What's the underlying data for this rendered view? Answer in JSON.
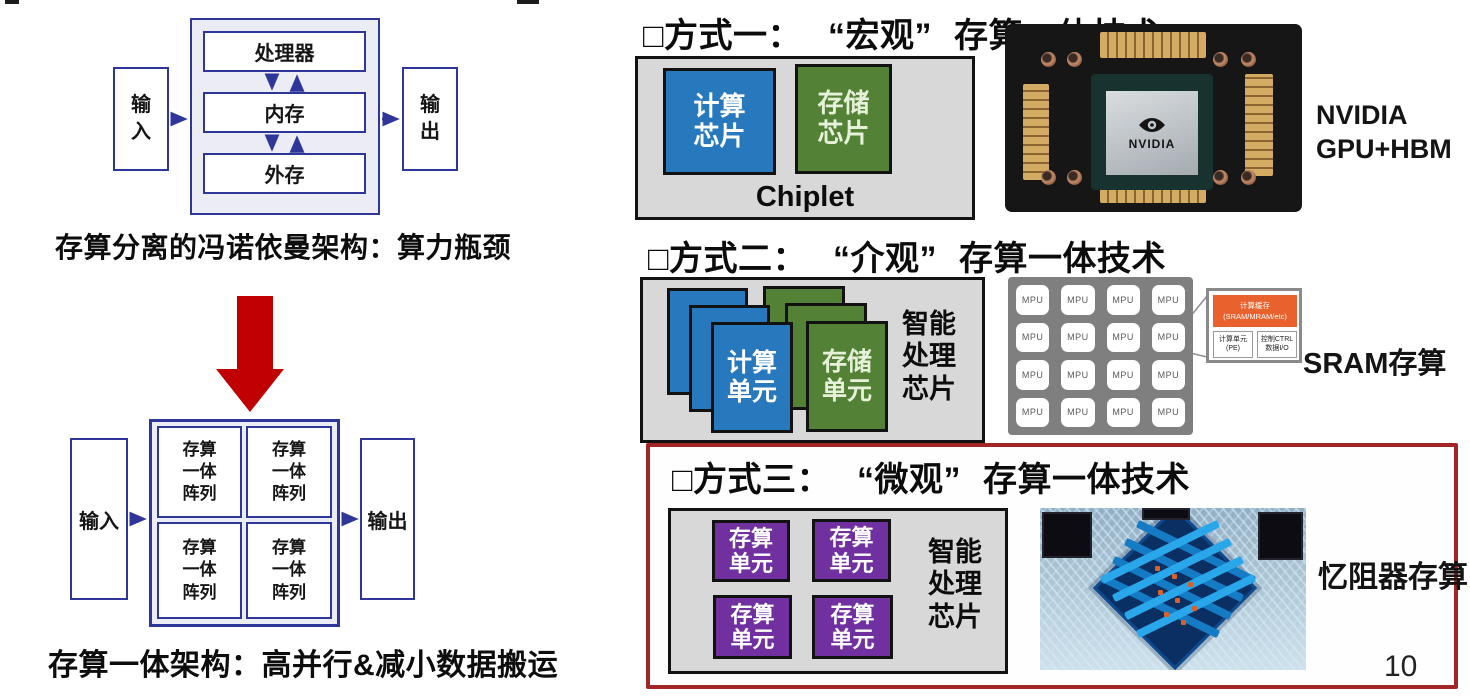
{
  "page": {
    "number": "10"
  },
  "colors": {
    "diagram_navy": "#2f3699",
    "red_arrow": "#c00000",
    "chip_blue": "#2878be",
    "chip_green": "#538135",
    "chip_purple": "#7030a0",
    "section3_border": "#a32626",
    "callout_orange": "#e9622e",
    "container_gray": "#d8d8d8"
  },
  "left": {
    "von_neumann": {
      "input": "输\n入",
      "output": "输\n出",
      "processor": "处理器",
      "memory": "内存",
      "external_storage": "外存",
      "caption": "存算分离的冯诺依曼架构：算力瓶颈"
    },
    "cim_arch": {
      "input": "输入",
      "output": "输出",
      "array": "存算\n一体\n阵列",
      "caption": "存算一体架构：高并行&减小数据搬运"
    }
  },
  "sections": {
    "s1": {
      "bullet_label": "□方式一：",
      "scale": "“宏观”",
      "tech": "存算一体技术",
      "compute_chip": "计算\n芯片",
      "memory_chip": "存储\n芯片",
      "container_label": "Chiplet",
      "photo": {
        "logo_word": "NVIDIA",
        "label_line1": "NVIDIA",
        "label_line2": "GPU+HBM"
      }
    },
    "s2": {
      "bullet_label": "□方式二：",
      "scale": "“介观”",
      "tech": "存算一体技术",
      "compute_unit": "计算\n单元",
      "memory_unit": "存储\n单元",
      "chip_label": "智能\n处理\n芯片",
      "mpu": "MPU",
      "callout": {
        "cache": "计算缓存\n(SRAM/MRAM/etc)",
        "pe": "计算单元\n(PE)",
        "ctrl": "控制CTRL\n数据I/O"
      },
      "photo_label": "SRAM存算"
    },
    "s3": {
      "bullet_label": "□方式三：",
      "scale": "“微观”",
      "tech": "存算一体技术",
      "cim_unit": "存算\n单元",
      "chip_label": "智能\n处理\n芯片",
      "photo_label": "忆阻器存算"
    }
  }
}
